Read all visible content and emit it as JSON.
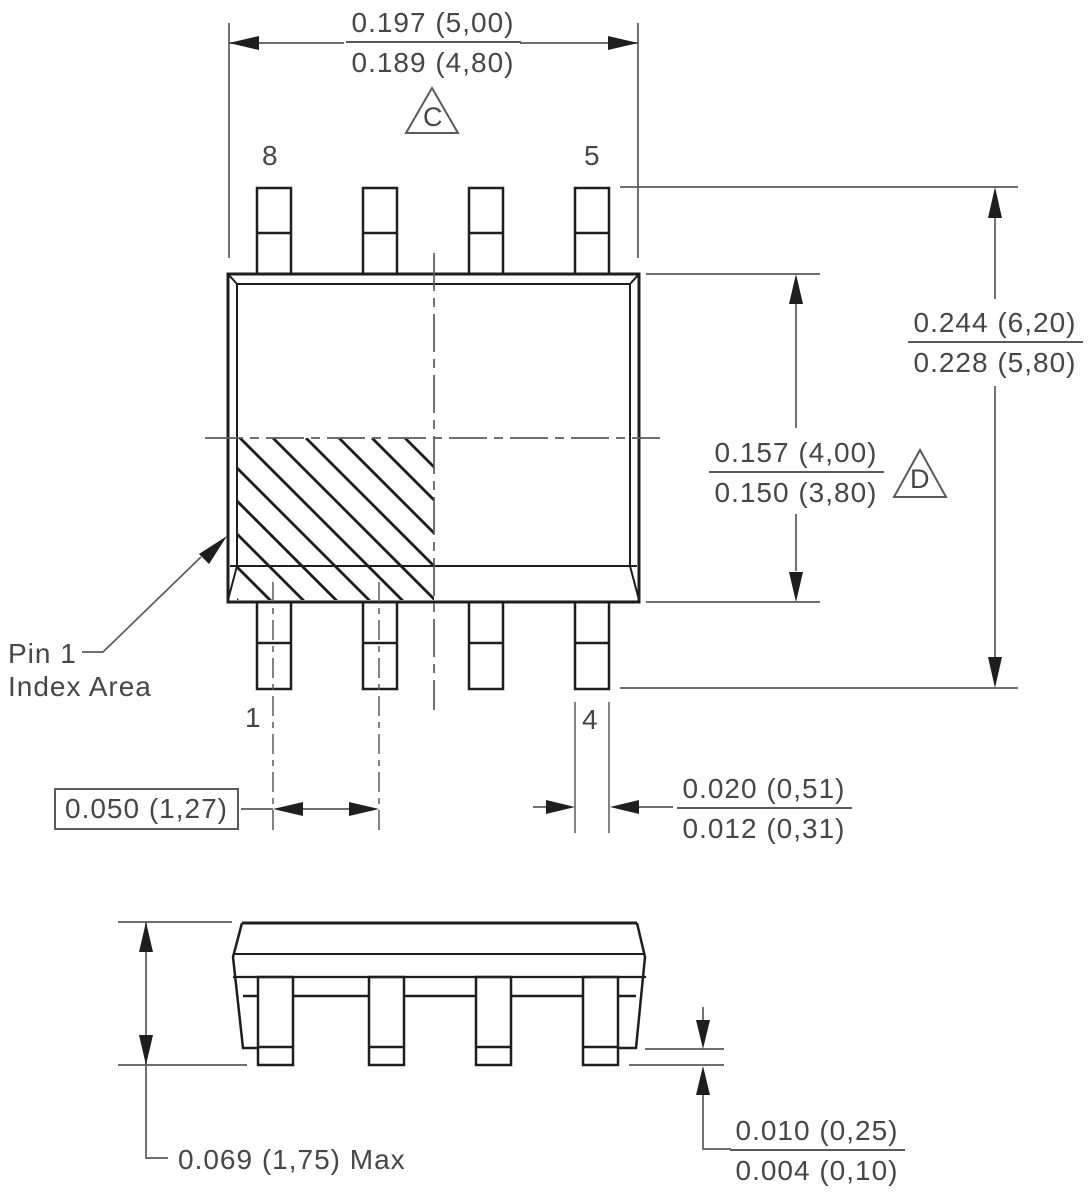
{
  "drawing": {
    "kind": "8-pin SOIC package outline, top view and side view",
    "colors": {
      "background": "#ffffff",
      "part_line": "#1e1e1e",
      "dim_line": "#5a5a5a",
      "text": "#464646"
    }
  },
  "dims": {
    "width": {
      "top": "0.197 (5,00)",
      "bottom": "0.189 (4,80)"
    },
    "overall": {
      "top": "0.244 (6,20)",
      "bottom": "0.228 (5,80)"
    },
    "body": {
      "top": "0.157 (4,00)",
      "bottom": "0.150 (3,80)"
    },
    "pitch": {
      "value": "0.050 (1,27)"
    },
    "lead_width": {
      "top": "0.020 (0,51)",
      "bottom": "0.012 (0,31)"
    },
    "height": {
      "value": "0.069 (1,75) Max"
    },
    "standoff": {
      "top": "0.010 (0,25)",
      "bottom": "0.004 (0,10)"
    }
  },
  "datums": {
    "c": "C",
    "d": "D"
  },
  "pins": {
    "p8": "8",
    "p5": "5",
    "p1": "1",
    "p4": "4"
  },
  "note": {
    "line1": "Pin 1",
    "line2": "Index Area"
  }
}
